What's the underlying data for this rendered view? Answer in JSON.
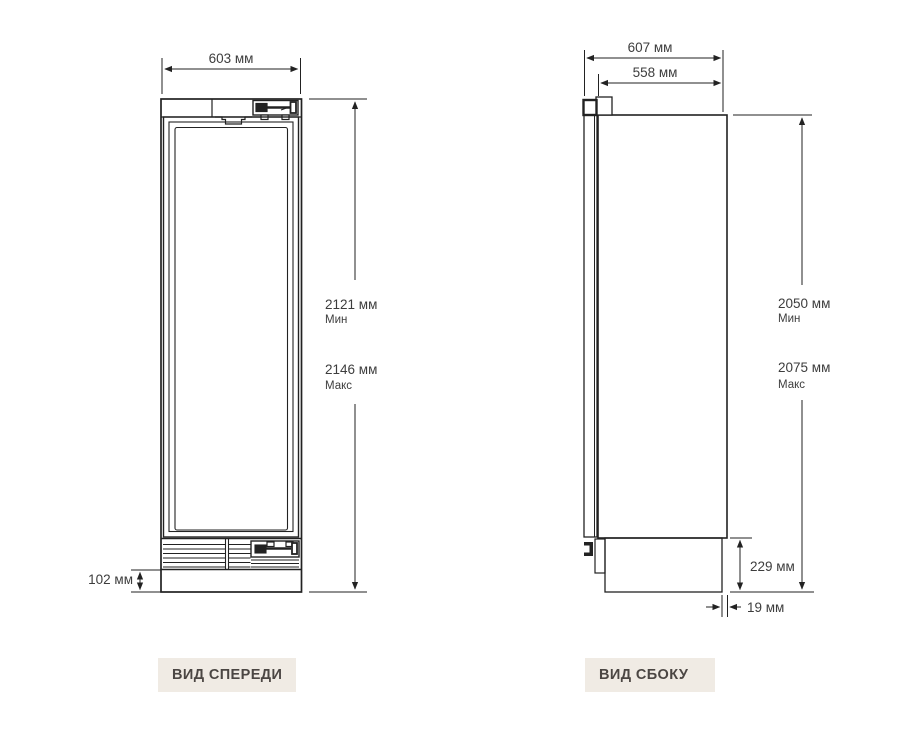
{
  "front_view": {
    "caption": "ВИД СПЕРЕДИ",
    "width": "603 мм",
    "height_min": "2121 мм",
    "height_min_qualifier": "Мин",
    "height_max": "2146 мм",
    "height_max_qualifier": "Макс",
    "plinth_height": "102 мм"
  },
  "side_view": {
    "caption": "ВИД СБОКУ",
    "depth_overall": "607 мм",
    "depth_body": "558 мм",
    "height_min": "2050 мм",
    "height_min_qualifier": "Мин",
    "height_max": "2075 мм",
    "height_max_qualifier": "Макс",
    "base_height": "229 мм",
    "base_recess": "19 мм"
  },
  "colors": {
    "background": "#ffffff",
    "line": "#222222",
    "dimension_text": "#3d3d3d",
    "caption_bg": "#f0ebe4",
    "caption_text": "#4b4643"
  }
}
